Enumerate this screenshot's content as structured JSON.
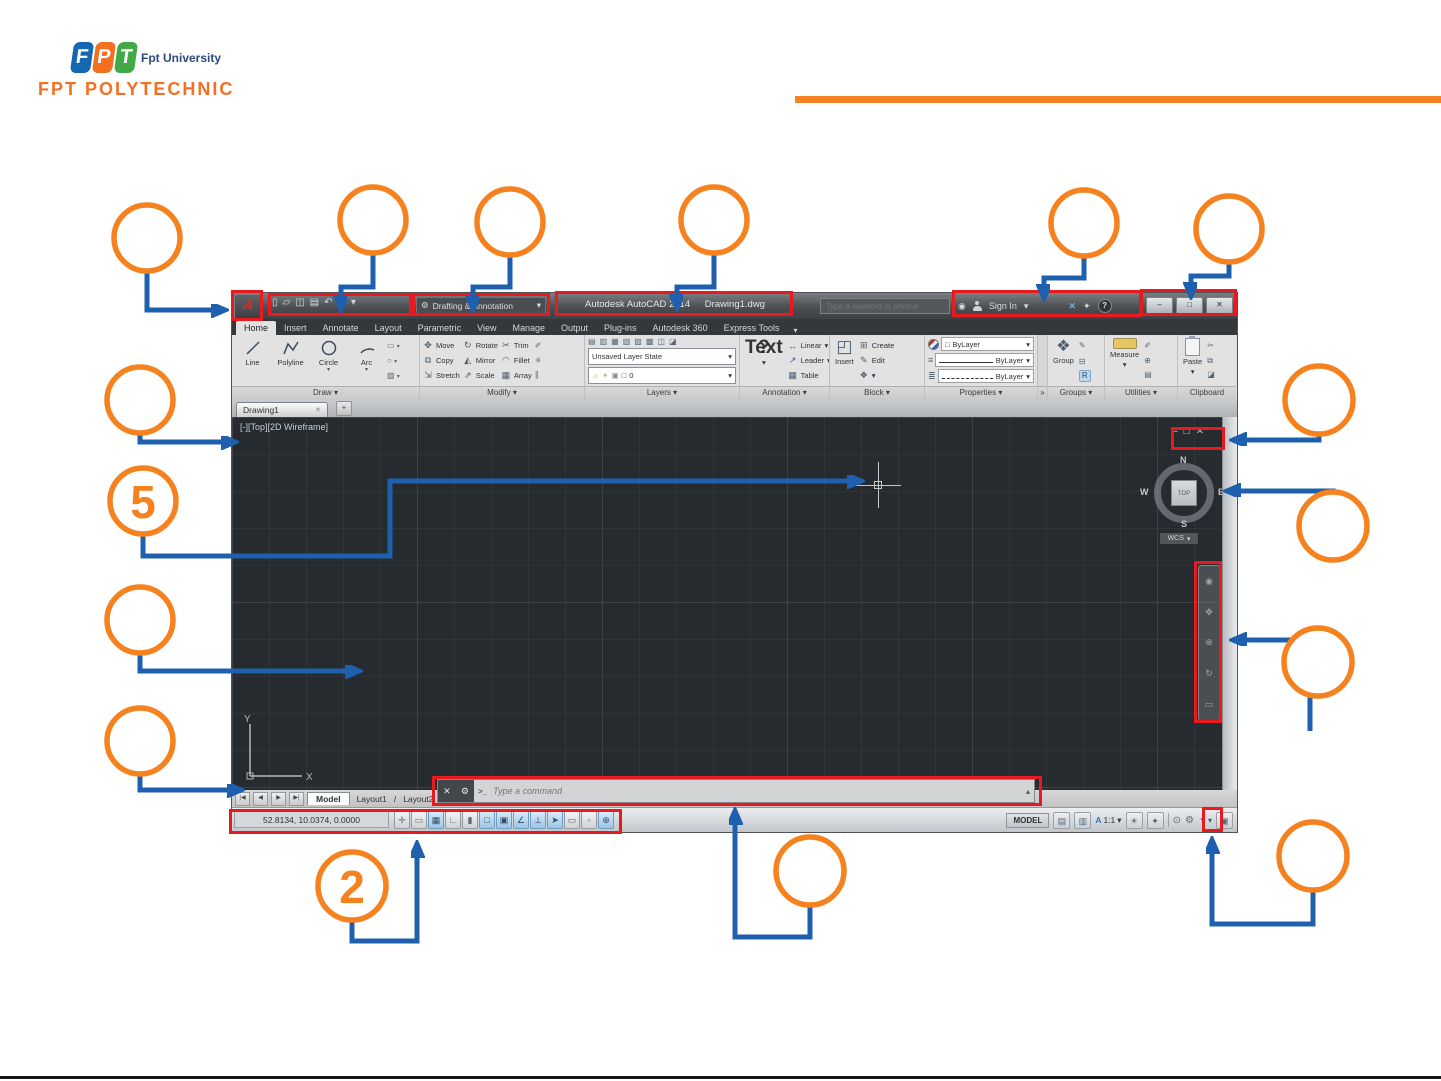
{
  "slide": {
    "logo": {
      "letters": [
        "F",
        "P",
        "T"
      ],
      "university": "Fpt University",
      "brand": "FPT POLYTECHNIC"
    },
    "callouts": {
      "five": "5",
      "two": "2"
    }
  },
  "titlebar": {
    "app_menu": "A",
    "workspace": "Drafting & Annotation",
    "product": "Autodesk AutoCAD 2014",
    "filename": "Drawing1.dwg",
    "search_placeholder": "Type a keyword or phrase",
    "sign_in": "Sign In"
  },
  "ribbon": {
    "tabs": [
      "Home",
      "Insert",
      "Annotate",
      "Layout",
      "Parametric",
      "View",
      "Manage",
      "Output",
      "Plug-ins",
      "Autodesk 360",
      "Express Tools"
    ],
    "draw": {
      "label": "Draw",
      "tools": [
        "Line",
        "Polyline",
        "Circle",
        "Arc"
      ]
    },
    "modify": {
      "label": "Modify",
      "col1": [
        "Move",
        "Copy",
        "Stretch"
      ],
      "col2": [
        "Rotate",
        "Mirror",
        "Scale"
      ],
      "col3": [
        "Trim",
        "Fillet",
        "Array"
      ]
    },
    "layers": {
      "label": "Layers",
      "state": "Unsaved Layer State",
      "layer_name": "0"
    },
    "annotation": {
      "label": "Annotation",
      "big": "Text",
      "items": [
        "Linear",
        "Leader",
        "Table"
      ]
    },
    "block": {
      "label": "Block",
      "big": "Insert",
      "items": [
        "Create",
        "Edit"
      ]
    },
    "properties": {
      "label": "Properties",
      "rows": [
        "ByLayer",
        "ByLayer",
        "ByLayer"
      ]
    },
    "groups": {
      "label": "Groups",
      "big": "Group",
      "r_badge": "R"
    },
    "utilities": {
      "label": "Utilities",
      "big": "Measure"
    },
    "clipboard": {
      "label": "Clipboard",
      "big": "Paste"
    },
    "overflow": "»"
  },
  "file_tab": "Drawing1",
  "canvas": {
    "viewport_label": "[-][Top][2D Wireframe]",
    "viewcube": {
      "n": "N",
      "e": "E",
      "s": "S",
      "w": "W",
      "top": "TOP",
      "wcs": "WCS"
    },
    "ucs": {
      "x": "X",
      "y": "Y"
    }
  },
  "command_line": {
    "prompt": ">_",
    "placeholder": "Type a command"
  },
  "layout_bar": {
    "tabs": [
      "Model",
      "Layout1",
      "Layout2"
    ]
  },
  "status_bar": {
    "coordinates": "52.8134, 10.0374, 0.0000",
    "model": "MODEL",
    "annotation_scale_letter": "A",
    "annotation_scale": "1:1",
    "toggles": [
      {
        "g": "✛",
        "on": false
      },
      {
        "g": "▭",
        "on": false
      },
      {
        "g": "▦",
        "on": true
      },
      {
        "g": "∟",
        "on": false
      },
      {
        "g": "▮",
        "on": false
      },
      {
        "g": "□",
        "on": true
      },
      {
        "g": "▣",
        "on": true
      },
      {
        "g": "∠",
        "on": true
      },
      {
        "g": "⊥",
        "on": true
      },
      {
        "g": "➤",
        "on": true
      },
      {
        "g": "▭",
        "on": false
      },
      {
        "g": "▫",
        "on": false
      },
      {
        "g": "⊕",
        "on": true
      }
    ]
  },
  "icons": {
    "caret": "▾",
    "new": "▯",
    "open": "▱",
    "save": "◫",
    "plot": "▤",
    "undo": "↶",
    "redo": "↷",
    "gear": "⚙",
    "search": "◉",
    "exchange": "✕",
    "family": "✦",
    "help": "?",
    "minimize": "–",
    "restore": "□",
    "close": "✕",
    "move": "✥",
    "copy": "⧉",
    "stretch": "⇲",
    "rotate": "↻",
    "mirror": "◭",
    "scale": "⇗",
    "trim": "✂",
    "fillet": "◠",
    "array": "▦",
    "erase": "✐",
    "explode": "✳",
    "offset": "∥",
    "layer_minis": [
      "▤",
      "▥",
      "▦",
      "▧",
      "▨",
      "▩",
      "◫",
      "◪"
    ],
    "bulb": "☼",
    "sun": "☀",
    "lock": "▣",
    "swatch": "□",
    "linear": "↔",
    "leader": "↗",
    "table": "▦",
    "insert_big": "◰",
    "create": "⊞",
    "edit": "✎",
    "block_mini": "❖",
    "lines3": "≡",
    "lines3b": "≣",
    "group": "❖",
    "group_edit": "✎",
    "ungroup": "⊟",
    "util1": "✐",
    "util2": "⊕",
    "util3": "▤",
    "cut": "✂",
    "copyclip": "⧉",
    "pastespec": "◪",
    "vp_min": "–",
    "vp_restore": "□",
    "vp_close": "✕",
    "tab_close": "✕",
    "tab_new": "+",
    "nav_first": "|◀",
    "nav_prev": "◀",
    "nav_next": "▶",
    "nav_last": "▶|",
    "cmd_close": "✕",
    "cmd_tools": "⚙",
    "cmd_up": "▴",
    "qv1": "▤",
    "qv2": "▥",
    "sb1": "☀",
    "sb2": "✦",
    "round1": "⊙",
    "round2": "⚙",
    "round3": "◔",
    "clean": "▣",
    "nav_glyphs": [
      "◉",
      "✥",
      "⊕",
      "↻",
      "▭"
    ]
  }
}
